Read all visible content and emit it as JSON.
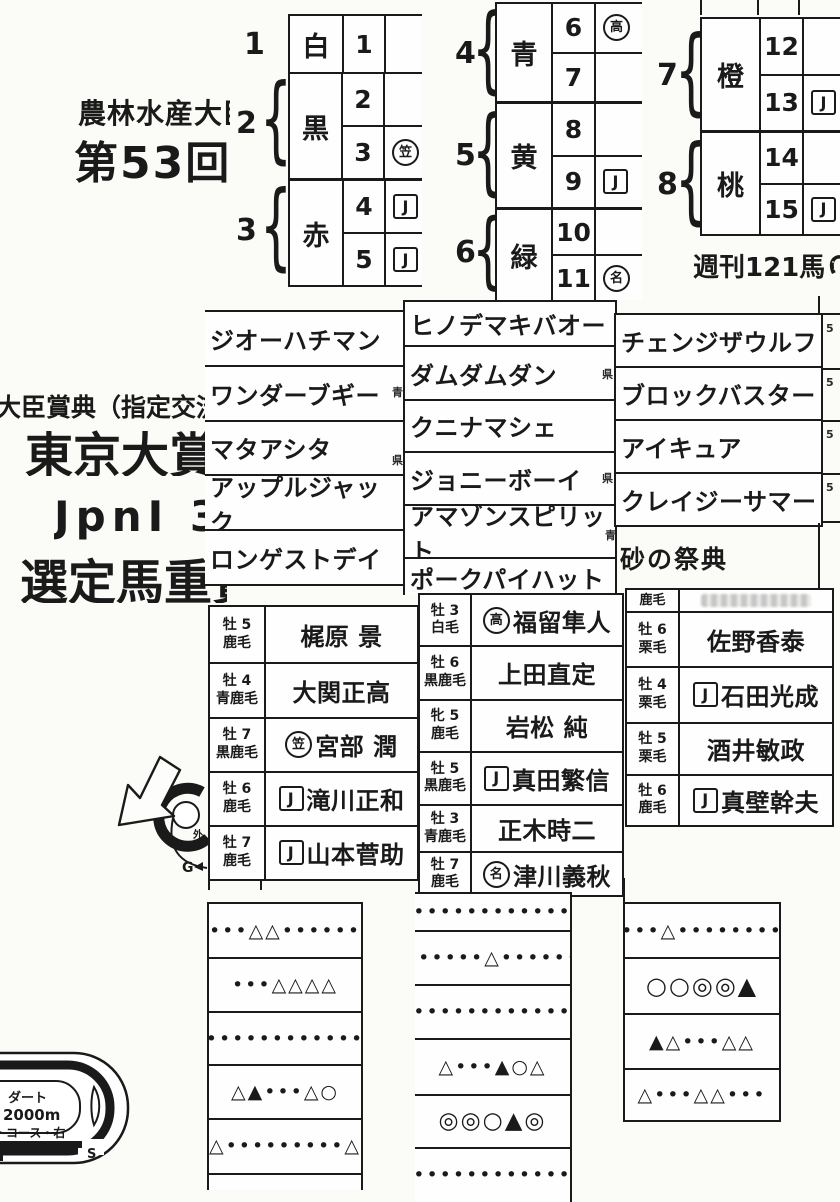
{
  "header": {
    "ministry_line": "農林水産大臣",
    "round": "第53回",
    "designation": "大臣賞典（指定交流",
    "race_title": "東京大賞典",
    "grade_line": "JpnⅠ 3",
    "selection_line": "選定馬重賞",
    "catchphrase": "砂の祭典",
    "magazine": "週刊121馬"
  },
  "waku_tables": {
    "left": {
      "groups": [
        {
          "waku": "1",
          "color": "白",
          "horses": [
            {
              "num": "1",
              "mark": "",
              "mark_type": "none"
            }
          ]
        },
        {
          "waku": "2",
          "color": "黒",
          "horses": [
            {
              "num": "2",
              "mark": "",
              "mark_type": "none"
            },
            {
              "num": "3",
              "mark": "笠",
              "mark_type": "circle"
            }
          ]
        },
        {
          "waku": "3",
          "color": "赤",
          "horses": [
            {
              "num": "4",
              "mark": "J",
              "mark_type": "box"
            },
            {
              "num": "5",
              "mark": "J",
              "mark_type": "box"
            }
          ]
        }
      ]
    },
    "middle": {
      "groups": [
        {
          "waku": "4",
          "color": "青",
          "horses": [
            {
              "num": "6",
              "mark": "高",
              "mark_type": "circle"
            },
            {
              "num": "7",
              "mark": "",
              "mark_type": "none"
            }
          ]
        },
        {
          "waku": "5",
          "color": "黄",
          "horses": [
            {
              "num": "8",
              "mark": "",
              "mark_type": "none"
            },
            {
              "num": "9",
              "mark": "J",
              "mark_type": "box"
            }
          ]
        },
        {
          "waku": "6",
          "color": "緑",
          "horses": [
            {
              "num": "10",
              "mark": "",
              "mark_type": "none"
            },
            {
              "num": "11",
              "mark": "名",
              "mark_type": "circle"
            }
          ]
        }
      ]
    },
    "right": {
      "groups": [
        {
          "waku": "7",
          "color": "橙",
          "horses": [
            {
              "num": "12",
              "mark": "",
              "mark_type": "none"
            },
            {
              "num": "13",
              "mark": "J",
              "mark_type": "box"
            }
          ]
        },
        {
          "waku": "8",
          "color": "桃",
          "horses": [
            {
              "num": "14",
              "mark": "",
              "mark_type": "none"
            },
            {
              "num": "15",
              "mark": "J",
              "mark_type": "box"
            }
          ]
        }
      ]
    }
  },
  "horse_names": {
    "col1": [
      "ジオーハチマン",
      "ワンダーブギー",
      "マタアシタ",
      "アップルジャック",
      "ロンゲストデイ"
    ],
    "col2": [
      "ヒノデマキバオー",
      "ダムダムダン",
      "クニナマシェ",
      "ジョニーボーイ",
      "アマゾンスピリット",
      "ポークパイハット"
    ],
    "col3": [
      "チェンジザウルフ",
      "ブロックバスター",
      "アイキュア",
      "クレイジーサマー"
    ]
  },
  "entries": {
    "left": [
      {
        "sex_age": "牡 5",
        "coat": "鹿毛",
        "name": "梶原 景",
        "mark": "",
        "mark_type": "none"
      },
      {
        "sex_age": "牡 4",
        "coat": "青鹿毛",
        "name": "大関正高",
        "mark": "",
        "mark_type": "none"
      },
      {
        "sex_age": "牡 7",
        "coat": "黒鹿毛",
        "name": "宮部 潤",
        "mark": "笠",
        "mark_type": "circle"
      },
      {
        "sex_age": "牡 6",
        "coat": "鹿毛",
        "name": "滝川正和",
        "mark": "J",
        "mark_type": "box"
      },
      {
        "sex_age": "牡 7",
        "coat": "鹿毛",
        "name": "山本菅助",
        "mark": "J",
        "mark_type": "box"
      }
    ],
    "middle": [
      {
        "sex_age": "牡 3",
        "coat": "白毛",
        "name": "福留隼人",
        "mark": "高",
        "mark_type": "circle"
      },
      {
        "sex_age": "牡 6",
        "coat": "黒鹿毛",
        "name": "上田直定",
        "mark": "",
        "mark_type": "none"
      },
      {
        "sex_age": "牝 5",
        "coat": "鹿毛",
        "name": "岩松 純",
        "mark": "",
        "mark_type": "none"
      },
      {
        "sex_age": "牡 5",
        "coat": "黒鹿毛",
        "name": "真田繁信",
        "mark": "J",
        "mark_type": "box"
      },
      {
        "sex_age": "牡 3",
        "coat": "青鹿毛",
        "name": "正木時二",
        "mark": "",
        "mark_type": "none"
      },
      {
        "sex_age": "牡 7",
        "coat": "鹿毛",
        "name": "津川義秋",
        "mark": "名",
        "mark_type": "circle"
      }
    ],
    "right": [
      {
        "sex_age": "",
        "coat": "鹿毛",
        "name": "",
        "mark": "",
        "mark_type": "none"
      },
      {
        "sex_age": "牡 6",
        "coat": "栗毛",
        "name": "佐野香泰",
        "mark": "",
        "mark_type": "none"
      },
      {
        "sex_age": "牡 4",
        "coat": "栗毛",
        "name": "石田光成",
        "mark": "J",
        "mark_type": "box"
      },
      {
        "sex_age": "牡 5",
        "coat": "栗毛",
        "name": "酒井敏政",
        "mark": "",
        "mark_type": "none"
      },
      {
        "sex_age": "牡 6",
        "coat": "鹿毛",
        "name": "真壁幹夫",
        "mark": "J",
        "mark_type": "box"
      }
    ]
  },
  "marks": {
    "col1": [
      "•••△△••••••",
      "•••△△△△",
      "••••••••••••••",
      "△▲•••△○",
      "△•••••••••△"
    ],
    "col2": [
      "••••••••••••••",
      "••••••△••••••",
      "••••••••••••••",
      "△•••▲○△",
      "◎◎○▲◎",
      "••••••••••••••"
    ],
    "col3": [
      "•••△••••••••",
      "○○◎◎▲",
      "▲△•••△△",
      "△•••△△•••"
    ]
  },
  "course": {
    "surface": "ダート",
    "distance": "2000m",
    "layout": "トコース・右",
    "start": "S",
    "goal": "G",
    "side_note": "外"
  },
  "fragments": {
    "edge_digit": "5",
    "blue": "青",
    "pref": "県"
  }
}
